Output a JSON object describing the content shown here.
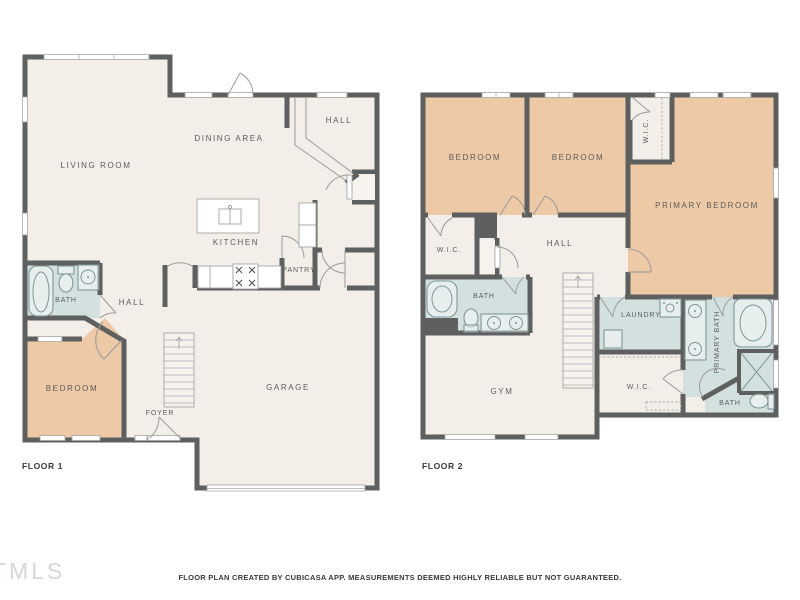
{
  "meta": {
    "footer": "FLOOR PLAN CREATED BY CUBICASA APP. MEASUREMENTS DEEMED HIGHLY RELIABLE BUT NOT GUARANTEED.",
    "watermark": "TMLS"
  },
  "palette": {
    "wall": "#5e5f5f",
    "floor": "#f3eee7",
    "bedroom_fill": "#edc9a6",
    "bath_fill": "#d2e1e0",
    "label_text": "#5c5c5c",
    "background": "#ffffff"
  },
  "floor1": {
    "caption": "FLOOR 1",
    "rooms": {
      "living": "LIVING ROOM",
      "dining": "DINING AREA",
      "hall_upper": "HALL",
      "kitchen": "KITCHEN",
      "pantry": "PANTRY",
      "bath": "BATH",
      "hall": "HALL",
      "bedroom": "BEDROOM",
      "foyer": "FOYER",
      "garage": "GARAGE"
    }
  },
  "floor2": {
    "caption": "FLOOR 2",
    "rooms": {
      "bedroom_a": "BEDROOM",
      "bedroom_b": "BEDROOM",
      "wic_top": "W.I.C.",
      "primary_bedroom": "PRIMARY BEDROOM",
      "wic_left": "W.I.C.",
      "hall": "HALL",
      "bath": "BATH",
      "laundry": "LAUNDRY",
      "gym": "GYM",
      "wic_lower": "W.I.C.",
      "primary_bath": "PRIMARY BATH",
      "bath_small": "BATH"
    }
  }
}
